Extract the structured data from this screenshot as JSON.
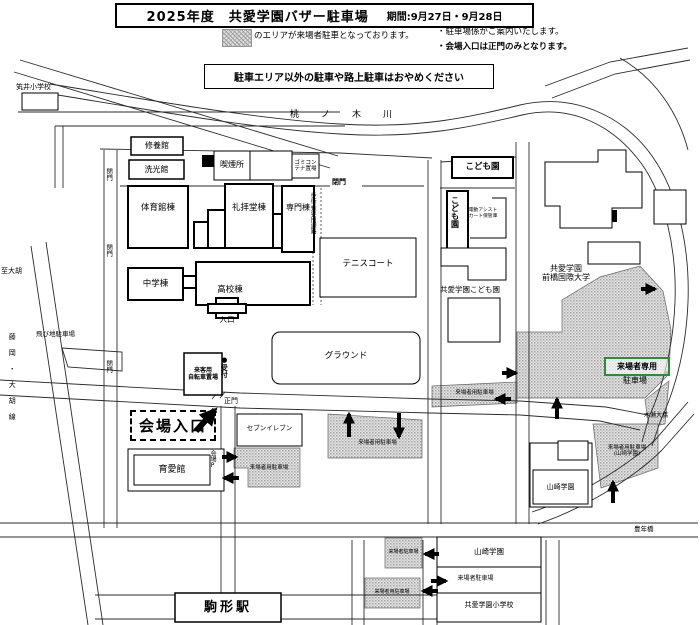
{
  "title": {
    "main": "2025年度　共愛学園バザー駐車場",
    "period": "期間:9月27日・9月28日"
  },
  "legend": {
    "area_note": "のエリアが来場者駐車となっております。",
    "bullet1": "・駐車場係がご案内いたします。",
    "bullet2": "・会場入口は正門のみとなります。",
    "warning": "駐車エリア以外の駐車や路上駐車はおやめください"
  },
  "map": {
    "river": "桃ノ木川",
    "roads": {
      "to_ogo": "至大胡",
      "route_name": "藤岡・大胡線",
      "kise_bridge": "木瀬大橋",
      "honen_bridge": "豊年橋"
    },
    "gates": {
      "g_top": "閉門",
      "g_left1": "閉門",
      "g_left2": "閉門",
      "g_left3": "閉門",
      "main_gate": "正門",
      "entrance": "入口"
    },
    "buildings": {
      "utsuboi_elem": "笂井小学校",
      "shuyokan": "修養館",
      "senkokan": "洗光館",
      "smoking_area": "喫煙所",
      "garbage": "ゴミコン\nテナ置場",
      "gym": "体育館棟",
      "chapel": "礼拝堂棟",
      "senmon": "専門棟",
      "walkway": "歩行者専用通路",
      "junior": "中学棟",
      "senior": "高校棟",
      "tennis": "テニスコート",
      "ground": "グラウンド",
      "kodomoen_sign": "こども園",
      "kodomoen_v": "こども園",
      "cart_storage": "電動アシスト\nカート保管庫",
      "kodomoen_full": "共愛学園こども園",
      "university": "共愛学園\n前橋国際大学",
      "ikueikan": "育愛館",
      "kaijo_p": "会場P",
      "bicycle": "来客用\n自転車置場",
      "reception": "●受付",
      "seven": "セブンイレブン",
      "yamazaki_block": "山崎学園",
      "yamazaki_box": "山崎学園",
      "kyoai_elem": "共愛学園小学校",
      "station": "駒形駅",
      "tobichi": "飛び地駐車場"
    },
    "parking": {
      "main_line1": "来場者専用",
      "main_line2": "駐車場",
      "center_strip": "来場者用駐車場",
      "ground_south": "来場者用駐車場",
      "ikuei_side": "来場者用駐車場",
      "yamazaki": "来場者用駐車場\n(山崎学園)",
      "south_small": "来場者駐車場",
      "south_west": "来場者用駐車場",
      "south_mid": "来場者駐車場"
    },
    "entrance_label": "会場入口"
  },
  "colors": {
    "accent_green": "#2e8b3a",
    "line": "#000000",
    "hatch_base": "#e2e2e2",
    "hatch_dot": "#aaaaaa"
  }
}
